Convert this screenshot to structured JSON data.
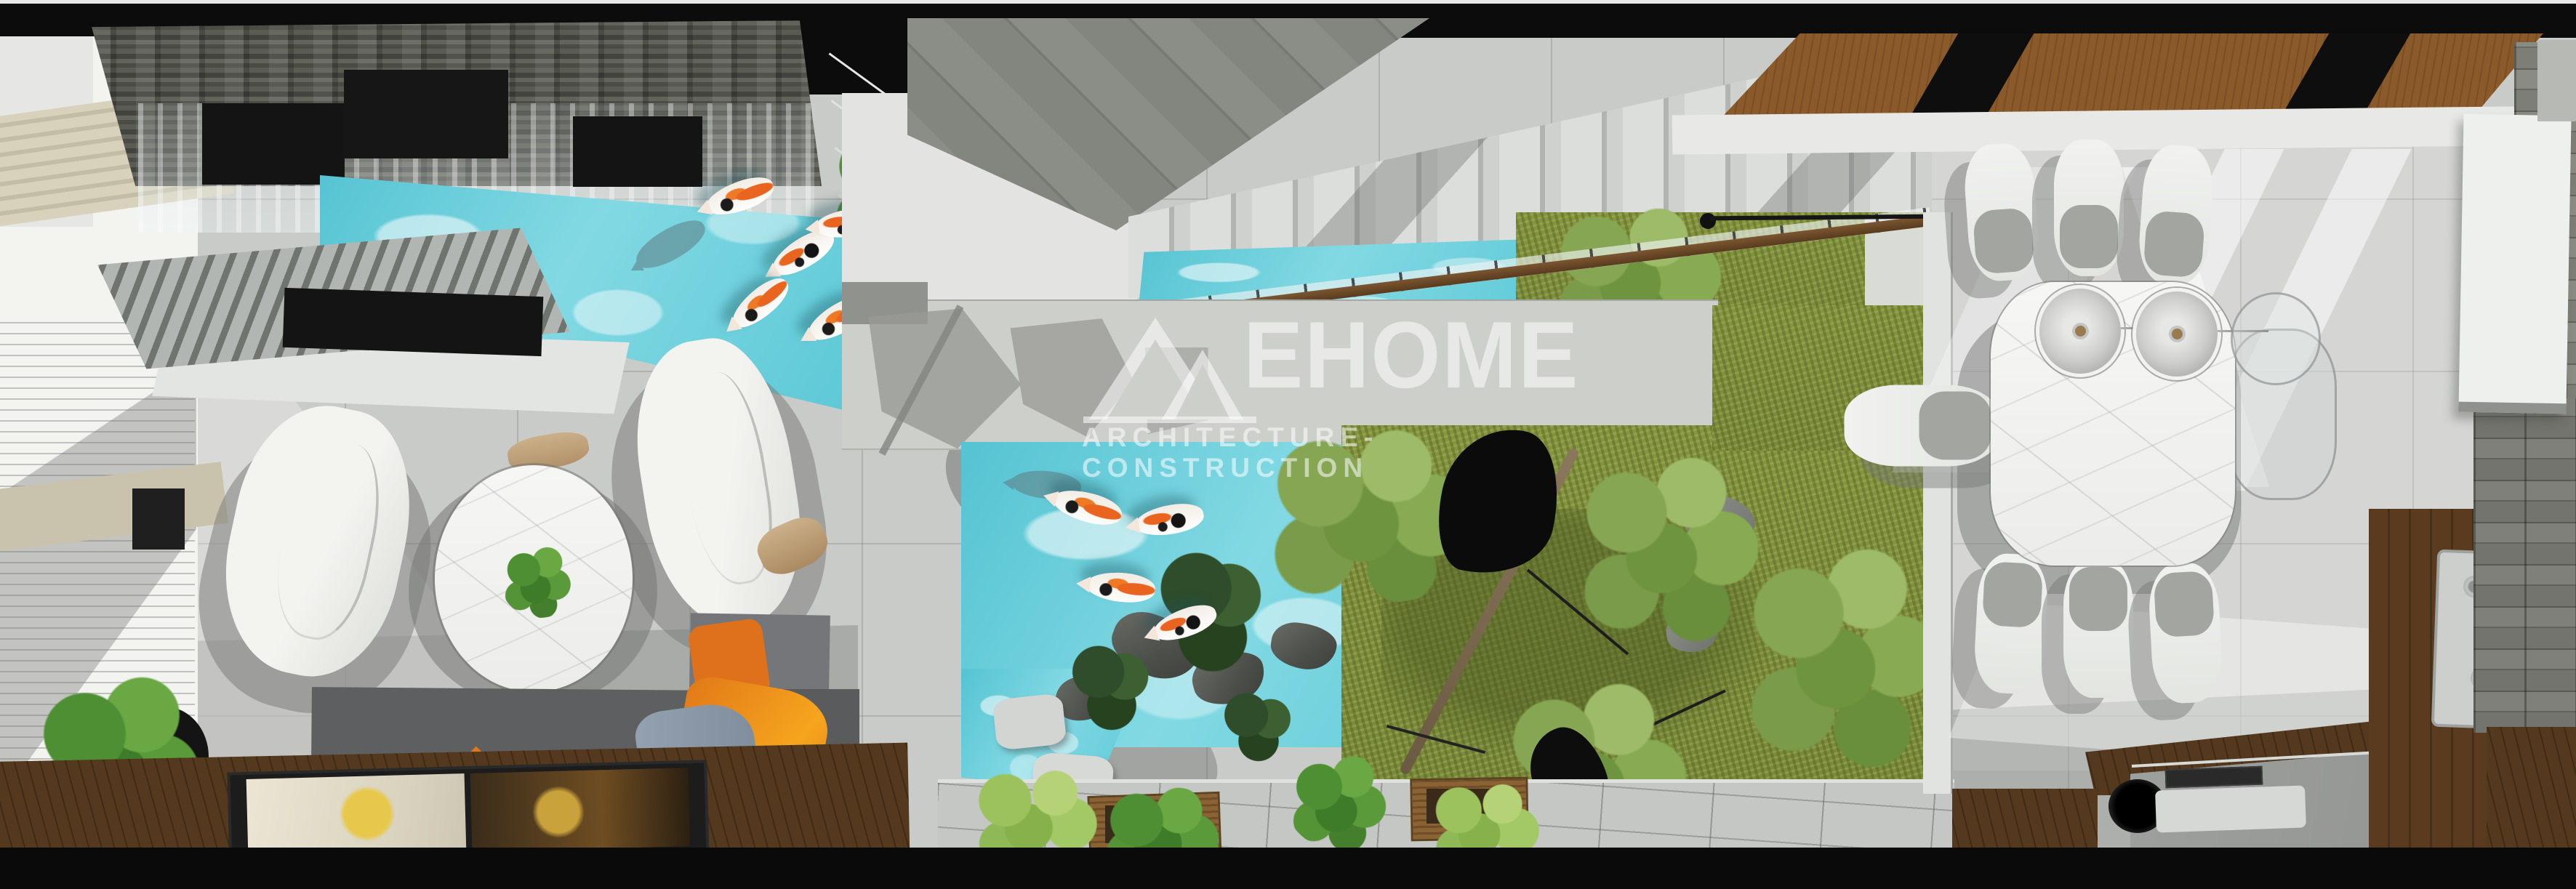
{
  "watermark": {
    "brand": "EHOME",
    "tagline": "ARCHITECTURE-CONSTRUCTION",
    "logo": "double-triangle-mountain-mark",
    "text_color": "#ffffff"
  },
  "scene": {
    "view": "top-down 3D architectural render of a modern house interior",
    "areas": [
      "waterfall-koi-pool",
      "living-room",
      "window-blinds",
      "tv-wood-deck",
      "staircase",
      "stair-pond",
      "indoor-courtyard-garden",
      "courtyard-koi-pond",
      "walkway-with-planters",
      "dining-room",
      "kitchen",
      "stone-feature-walls"
    ],
    "objects": {
      "living_room": [
        "armchair",
        "armchair",
        "round-marble-coffee-table",
        "gray-sofa",
        "orange-pillows",
        "ottoman",
        "potted-plant",
        "tv-panel"
      ],
      "dining_room": [
        "marble-dining-table",
        "eight-chairs",
        "pendant-lamps",
        "wood-slat-ceiling"
      ],
      "kitchen": [
        "stone-countertop",
        "cooktop",
        "sink-with-faucet",
        "wood-cabinets"
      ],
      "courtyard": [
        "koi-pond",
        "rocks",
        "stepping-stones",
        "tree",
        "shrubs",
        "planter-boxes"
      ]
    },
    "counts": {
      "koi_fish_upper_pool": 5,
      "koi_fish_courtyard_pond": 4,
      "dining_chairs": 8,
      "pendant_lamps": 3,
      "armchairs": 2,
      "planter_boxes": 2,
      "stair_steps": 13
    },
    "palette": {
      "water": "#5fc9d6",
      "grass": "#7e8f42",
      "floor_tile": "#c9cbc8",
      "wood_ceiling": "#8b5a2b",
      "deck_wood": "#503620",
      "sofa": "#5e6061",
      "accent_pillow": "#e07818",
      "black_ceiling": "#0c0c0c",
      "stone_slate": "#52534d",
      "marble": "#f3f3f1"
    }
  }
}
